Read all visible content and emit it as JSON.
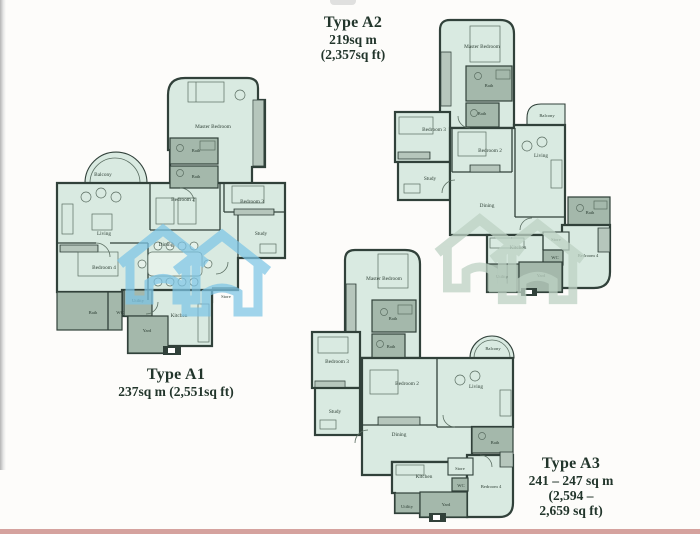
{
  "colors": {
    "bg": "#fdfcfa",
    "floor": "#d9eae1",
    "floor_light": "#e6f2ea",
    "wall": "#31413a",
    "wet": "#a4b8ab",
    "line": "#5a6d61",
    "label": "#2f4036",
    "title": "#22352b",
    "watermark_blue": "#7dc5e6",
    "watermark_faint": "#bdd2c4",
    "left_edge": "#b5b5b5",
    "bottom_edge": "#d5a29e"
  },
  "plans": [
    {
      "type": "A1",
      "title": "Type A1",
      "area_lines": [
        "237sq m (2,551sq ft)"
      ],
      "rooms": [
        "Master Bedroom",
        "Bath",
        "Bath",
        "Balcony",
        "Bedroom 2",
        "Bedroom 3",
        "Living",
        "Study",
        "Dining",
        "Bedroom 4",
        "Store",
        "Utility",
        "Bath",
        "WC",
        "Yard",
        "Kitchen"
      ]
    },
    {
      "type": "A2",
      "title": "Type A2",
      "area_lines": [
        "219sq m",
        "(2,357sq ft)"
      ],
      "rooms": [
        "Master Bedroom",
        "Bath",
        "Bath",
        "Bedroom 3",
        "Balcony",
        "Bedroom 2",
        "Living",
        "Study",
        "Dining",
        "Bath",
        "Store",
        "Kitchen",
        "WC",
        "Bedroom 4",
        "Utility",
        "Yard"
      ]
    },
    {
      "type": "A3",
      "title": "Type A3",
      "area_lines": [
        "241 – 247 sq m",
        "(2,594 –",
        "2,659 sq ft)"
      ],
      "rooms": [
        "Master Bedroom",
        "Bath",
        "Bath",
        "Bedroom 3",
        "Balcony",
        "Bedroom 2",
        "Living",
        "Study",
        "Dining",
        "Bath",
        "Store",
        "Kitchen",
        "WC",
        "Bedroom 4",
        "Utility",
        "Yard"
      ]
    }
  ]
}
